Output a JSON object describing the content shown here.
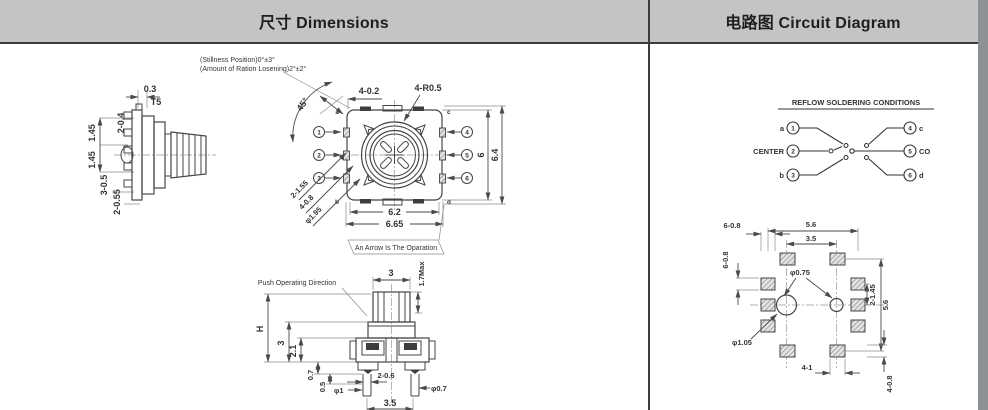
{
  "header": {
    "dimensions_title": "尺寸 Dimensions",
    "circuit_title": "电路图 Circuit Diagram"
  },
  "colors": {
    "header_bg": "#c6c4c2",
    "border": "#3c3c3c",
    "line": "#4a4a4a",
    "side_strip": "#8e9194"
  },
  "dimensions_panel": {
    "notes": {
      "line1": "(Stillness Position)0°±3°",
      "line2": "(Amount of Ration Losening)2°±2°"
    },
    "side_view": {
      "d_03": "0.3",
      "d_t5": "T5",
      "d_2_04": "2-0.4",
      "d_145a": "1.45",
      "d_145b": "1.45",
      "d_3_05": "3-0.5",
      "d_2_055": "2-0.55"
    },
    "top_view": {
      "d_4_02": "4-0.2",
      "d_4_r05": "4-R0.5",
      "angle": "45°",
      "corner_a": "a",
      "corner_b": "b",
      "corner_c": "c",
      "corner_d": "d",
      "pin1": "1",
      "pin2": "2",
      "pin3": "3",
      "pin4": "4",
      "pin5": "5",
      "pin6": "6",
      "d_2_155": "2-1.55",
      "d_4_08": "4-0.8",
      "d_phi195": "φ1.95",
      "d_62": "6.2",
      "d_665": "6.65",
      "d_6": "6",
      "d_64": "6.4",
      "arrow_note": "An Arrow Is The Oparation"
    },
    "push_view": {
      "label": "Push Operating Direction",
      "d_3_top": "3",
      "d_17max": "1.7Max",
      "d_h": "H",
      "d_3": "3",
      "d_21": "2.1",
      "d_07": "0.7",
      "d_05": "0.5",
      "d_phi1": "φ1",
      "d_2_06": "2-0.6",
      "d_phi07": "φ0.7",
      "d_35": "3.5"
    }
  },
  "circuit_panel": {
    "title": "REFLOW SOLDERING CONDITIONS",
    "pins": {
      "p1": "1",
      "p2": "2",
      "p3": "3",
      "p4": "4",
      "p5": "5",
      "p6": "6"
    },
    "labels": {
      "a": "a",
      "center": "CENTER",
      "b": "b",
      "c": "c",
      "co": "CO",
      "d": "d"
    },
    "pcb": {
      "d_6_08_top": "6-0.8",
      "d_56_top": "5.6",
      "d_35": "3.5",
      "d_6_08_left": "6-0.8",
      "d_phi075": "φ0.75",
      "d_2_145": "2-1.45",
      "d_56_right": "5.6",
      "d_phi105": "φ1.05",
      "d_4_1": "4-1",
      "d_4_08": "4-0.8"
    }
  }
}
